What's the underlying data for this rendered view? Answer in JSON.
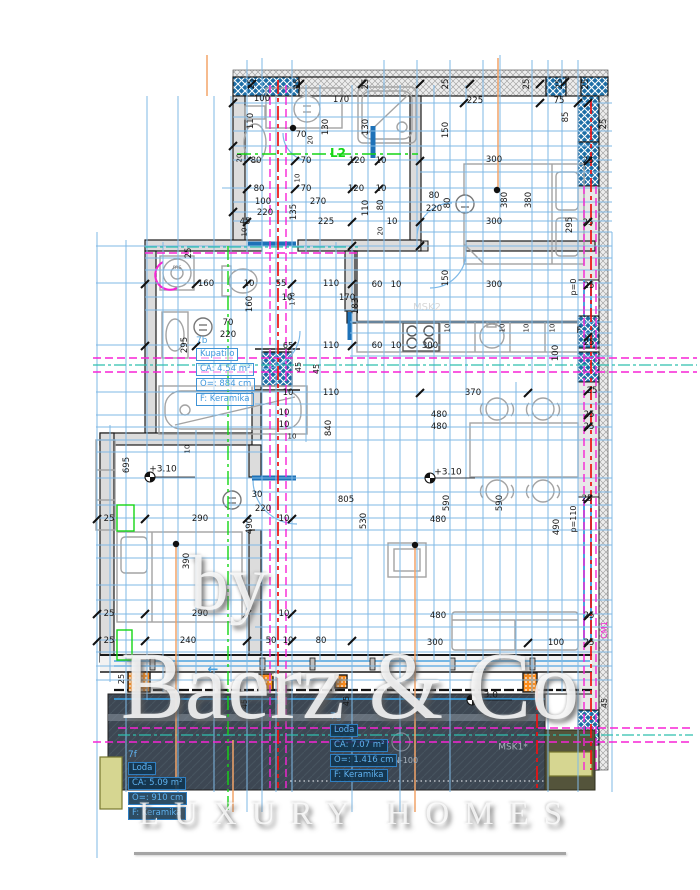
{
  "watermark": {
    "by": "by",
    "brand": "Baerz & Co",
    "tagline": "LUXURY HOMES"
  },
  "colors": {
    "grid_blue": "#7fb9e6",
    "hatch_blue": "#1d6ea6",
    "magenta": "#f723d5",
    "red": "#ee1111",
    "green": "#15d615",
    "teal": "#2fbfae",
    "orange_line": "#f2a469",
    "orange_column": "#ff8d1a",
    "terrace_dark": "#3d4753",
    "khaki": "#d6d691",
    "wall_gray": "#dcdcdc",
    "room_label_blue": "#43a0e8",
    "thick_blue": "#1e72b8"
  },
  "rooms": [
    {
      "id": "7b",
      "name": "Kupatilo",
      "area": "CA: 4.54 m²",
      "perimeter": "O=: 884 cm",
      "floor": "F: Keramika",
      "x": 196,
      "y": 336,
      "theme": "light"
    },
    {
      "id": "7f",
      "name": "Lođa",
      "area": "CA: 5.09 m²",
      "perimeter": "O=: 910 cm",
      "floor": "F: Keramika",
      "x": 128,
      "y": 750,
      "theme": "dark"
    },
    {
      "id": "7g",
      "name": "Lođa",
      "area": "CA: 7.07 m²",
      "perimeter": "O=: 1.416 cm",
      "floor": "F: Keramika",
      "x": 330,
      "y": 712,
      "theme": "dark"
    }
  ],
  "drawing": {
    "dims": [
      {
        "t": "25",
        "x": 252,
        "y": 84,
        "r": 1
      },
      {
        "t": "25",
        "x": 298,
        "y": 84,
        "r": 1
      },
      {
        "t": "25",
        "x": 366,
        "y": 84,
        "r": 1
      },
      {
        "t": "25",
        "x": 446,
        "y": 84,
        "r": 1
      },
      {
        "t": "25",
        "x": 527,
        "y": 84,
        "r": 1
      },
      {
        "t": "25",
        "x": 560,
        "y": 84,
        "r": 1
      },
      {
        "t": "25",
        "x": 586,
        "y": 84,
        "r": 1
      },
      {
        "t": "25",
        "x": 604,
        "y": 124,
        "r": 1
      },
      {
        "t": "100",
        "x": 262,
        "y": 99
      },
      {
        "t": "170",
        "x": 341,
        "y": 100
      },
      {
        "t": "110",
        "x": 251,
        "y": 121,
        "r": 1
      },
      {
        "t": "130",
        "x": 326,
        "y": 127,
        "r": 1
      },
      {
        "t": "130",
        "x": 366,
        "y": 127,
        "r": 1
      },
      {
        "t": "70",
        "x": 301,
        "y": 135
      },
      {
        "t": "20",
        "x": 311,
        "y": 140,
        "r": 1,
        "s": 7
      },
      {
        "t": "L2",
        "x": 338,
        "y": 153,
        "c": "green",
        "s": 12
      },
      {
        "t": "80",
        "x": 256,
        "y": 161
      },
      {
        "t": "70",
        "x": 306,
        "y": 161
      },
      {
        "t": "120",
        "x": 357,
        "y": 161
      },
      {
        "t": "10",
        "x": 381,
        "y": 161
      },
      {
        "t": "20",
        "x": 240,
        "y": 158,
        "r": 1,
        "s": 7
      },
      {
        "t": "80",
        "x": 259,
        "y": 189
      },
      {
        "t": "70",
        "x": 306,
        "y": 189
      },
      {
        "t": "120",
        "x": 356,
        "y": 189
      },
      {
        "t": "10",
        "x": 381,
        "y": 189
      },
      {
        "t": "10",
        "x": 298,
        "y": 178,
        "r": 1,
        "s": 7
      },
      {
        "t": "100",
        "x": 263,
        "y": 202
      },
      {
        "t": "270",
        "x": 318,
        "y": 202
      },
      {
        "t": "110",
        "x": 366,
        "y": 208,
        "r": 1
      },
      {
        "t": "80",
        "x": 381,
        "y": 205,
        "r": 1
      },
      {
        "t": "220",
        "x": 265,
        "y": 213
      },
      {
        "t": "135",
        "x": 294,
        "y": 212,
        "r": 1
      },
      {
        "t": "45",
        "x": 245,
        "y": 222
      },
      {
        "t": "225",
        "x": 326,
        "y": 222
      },
      {
        "t": "10",
        "x": 392,
        "y": 222
      },
      {
        "t": "20",
        "x": 381,
        "y": 231,
        "r": 1,
        "s": 7
      },
      {
        "t": "10",
        "x": 245,
        "y": 232,
        "r": 1,
        "s": 7
      },
      {
        "t": "225",
        "x": 475,
        "y": 101
      },
      {
        "t": "75",
        "x": 559,
        "y": 101
      },
      {
        "t": "85",
        "x": 566,
        "y": 117,
        "r": 1
      },
      {
        "t": "150",
        "x": 446,
        "y": 130,
        "r": 1
      },
      {
        "t": "300",
        "x": 494,
        "y": 160
      },
      {
        "t": "25",
        "x": 588,
        "y": 161
      },
      {
        "t": "80",
        "x": 434,
        "y": 196
      },
      {
        "t": "220",
        "x": 434,
        "y": 209
      },
      {
        "t": "80",
        "x": 448,
        "y": 203,
        "r": 1
      },
      {
        "t": "380",
        "x": 505,
        "y": 200,
        "r": 1
      },
      {
        "t": "380",
        "x": 529,
        "y": 200,
        "r": 1
      },
      {
        "t": "300",
        "x": 494,
        "y": 222
      },
      {
        "t": "295",
        "x": 570,
        "y": 225,
        "r": 1
      },
      {
        "t": "25",
        "x": 588,
        "y": 223
      },
      {
        "t": "150",
        "x": 446,
        "y": 278,
        "r": 1
      },
      {
        "t": "300",
        "x": 494,
        "y": 285
      },
      {
        "t": "p=0",
        "x": 574,
        "y": 287,
        "r": 1,
        "s": 8
      },
      {
        "t": "25",
        "x": 589,
        "y": 286
      },
      {
        "t": "25",
        "x": 189,
        "y": 253,
        "r": 1
      },
      {
        "t": "160",
        "x": 206,
        "y": 284
      },
      {
        "t": "10",
        "x": 249,
        "y": 284
      },
      {
        "t": "55",
        "x": 281,
        "y": 284
      },
      {
        "t": "110",
        "x": 331,
        "y": 284
      },
      {
        "t": "10",
        "x": 287,
        "y": 298
      },
      {
        "t": "170",
        "x": 347,
        "y": 298
      },
      {
        "t": "160",
        "x": 250,
        "y": 304,
        "r": 1
      },
      {
        "t": "170",
        "x": 293,
        "y": 299,
        "r": 1,
        "s": 7
      },
      {
        "t": "70",
        "x": 228,
        "y": 323
      },
      {
        "t": "220",
        "x": 228,
        "y": 335
      },
      {
        "t": "295",
        "x": 185,
        "y": 345,
        "r": 1
      },
      {
        "t": "65",
        "x": 288,
        "y": 346,
        "s": 8
      },
      {
        "t": "110",
        "x": 331,
        "y": 346
      },
      {
        "t": "45",
        "x": 299,
        "y": 367,
        "r": 1,
        "s": 8
      },
      {
        "t": "45",
        "x": 317,
        "y": 369,
        "r": 1,
        "s": 8
      },
      {
        "t": "110",
        "x": 331,
        "y": 393
      },
      {
        "t": "10",
        "x": 288,
        "y": 393
      },
      {
        "t": "10",
        "x": 284,
        "y": 413
      },
      {
        "t": "10",
        "x": 284,
        "y": 425
      },
      {
        "t": "840",
        "x": 329,
        "y": 428,
        "r": 1
      },
      {
        "t": "10",
        "x": 292,
        "y": 437,
        "s": 7
      },
      {
        "t": "60",
        "x": 377,
        "y": 285
      },
      {
        "t": "10",
        "x": 396,
        "y": 285
      },
      {
        "t": "183",
        "x": 356,
        "y": 306,
        "r": 1
      },
      {
        "t": "MSK2",
        "x": 427,
        "y": 308,
        "c": "faint",
        "s": 10
      },
      {
        "t": "10",
        "x": 448,
        "y": 328,
        "r": 1,
        "s": 7
      },
      {
        "t": "10",
        "x": 503,
        "y": 328,
        "r": 1,
        "s": 7
      },
      {
        "t": "10",
        "x": 527,
        "y": 328,
        "r": 1,
        "s": 7
      },
      {
        "t": "10",
        "x": 553,
        "y": 328,
        "r": 1,
        "s": 7
      },
      {
        "t": "F",
        "x": 579,
        "y": 331
      },
      {
        "t": "300",
        "x": 430,
        "y": 346
      },
      {
        "t": "60",
        "x": 377,
        "y": 346
      },
      {
        "t": "10",
        "x": 396,
        "y": 346
      },
      {
        "t": "100",
        "x": 556,
        "y": 353,
        "r": 1
      },
      {
        "t": "370",
        "x": 473,
        "y": 393
      },
      {
        "t": "25",
        "x": 592,
        "y": 391
      },
      {
        "t": "480",
        "x": 439,
        "y": 415
      },
      {
        "t": "480",
        "x": 439,
        "y": 427
      },
      {
        "t": "25",
        "x": 589,
        "y": 415
      },
      {
        "t": "25",
        "x": 589,
        "y": 427
      },
      {
        "t": "25",
        "x": 589,
        "y": 343
      },
      {
        "t": "+3.10",
        "x": 448,
        "y": 473,
        "s": 9
      },
      {
        "t": "590",
        "x": 447,
        "y": 503,
        "r": 1
      },
      {
        "t": "590",
        "x": 500,
        "y": 503,
        "r": 1
      },
      {
        "t": "805",
        "x": 346,
        "y": 500
      },
      {
        "t": "530",
        "x": 364,
        "y": 521,
        "r": 1
      },
      {
        "t": "480",
        "x": 438,
        "y": 520
      },
      {
        "t": "490",
        "x": 557,
        "y": 527,
        "r": 1
      },
      {
        "t": "p=110",
        "x": 574,
        "y": 519,
        "r": 1,
        "s": 8
      },
      {
        "t": "25",
        "x": 587,
        "y": 499
      },
      {
        "t": "480",
        "x": 438,
        "y": 616
      },
      {
        "t": "300",
        "x": 435,
        "y": 643
      },
      {
        "t": "100",
        "x": 556,
        "y": 643
      },
      {
        "t": "25",
        "x": 589,
        "y": 616
      },
      {
        "t": "25",
        "x": 589,
        "y": 643
      },
      {
        "t": "10",
        "x": 188,
        "y": 449,
        "r": 1,
        "s": 7
      },
      {
        "t": "695",
        "x": 127,
        "y": 465,
        "r": 1
      },
      {
        "t": "+3.10",
        "x": 163,
        "y": 470,
        "s": 9
      },
      {
        "t": "30",
        "x": 257,
        "y": 495
      },
      {
        "t": "220",
        "x": 263,
        "y": 509
      },
      {
        "t": "10",
        "x": 284,
        "y": 519
      },
      {
        "t": "290",
        "x": 200,
        "y": 519
      },
      {
        "t": "490",
        "x": 250,
        "y": 526,
        "r": 1
      },
      {
        "t": "25",
        "x": 109,
        "y": 519
      },
      {
        "t": "390",
        "x": 187,
        "y": 561,
        "r": 1
      },
      {
        "t": "290",
        "x": 200,
        "y": 614
      },
      {
        "t": "25",
        "x": 109,
        "y": 614
      },
      {
        "t": "10",
        "x": 284,
        "y": 614
      },
      {
        "t": "240",
        "x": 188,
        "y": 641
      },
      {
        "t": "50",
        "x": 271,
        "y": 641
      },
      {
        "t": "10",
        "x": 288,
        "y": 641
      },
      {
        "t": "80",
        "x": 321,
        "y": 641
      },
      {
        "t": "25",
        "x": 109,
        "y": 641
      },
      {
        "t": "25",
        "x": 122,
        "y": 679,
        "r": 1,
        "s": 8
      },
      {
        "t": "45",
        "x": 245,
        "y": 704,
        "r": 1,
        "s": 8
      },
      {
        "t": "45",
        "x": 283,
        "y": 701,
        "r": 1,
        "s": 8
      },
      {
        "t": "45",
        "x": 347,
        "y": 701,
        "r": 1,
        "s": 8
      },
      {
        "t": "45",
        "x": 605,
        "y": 703,
        "r": 1,
        "s": 8
      },
      {
        "t": "+3.0",
        "x": 487,
        "y": 696,
        "s": 9
      },
      {
        "t": "MSK1*",
        "x": 513,
        "y": 748,
        "c": "dark-note",
        "s": 9
      },
      {
        "t": "ps DN-100",
        "x": 397,
        "y": 761,
        "c": "dark-note",
        "s": 8
      },
      {
        "t": "CM1",
        "x": 605,
        "y": 630,
        "r": 1,
        "c": "magenta",
        "s": 8
      },
      {
        "t": "←",
        "x": 213,
        "y": 670,
        "c": "bluearrow",
        "s": 13
      },
      {
        "t": "←",
        "x": 481,
        "y": 670,
        "c": "bluearrow",
        "s": 13
      },
      {
        "t": "ms",
        "x": 177,
        "y": 268,
        "c": "gray",
        "s": 6
      }
    ],
    "vlines": [
      [
        97,
        232,
        858
      ],
      [
        110,
        425,
        682
      ],
      [
        126,
        240,
        792
      ],
      [
        147,
        96,
        700
      ],
      [
        163,
        242,
        692
      ],
      [
        178,
        96,
        792
      ],
      [
        196,
        430,
        682
      ],
      [
        214,
        96,
        792
      ],
      [
        231,
        96,
        682
      ],
      [
        247,
        60,
        812
      ],
      [
        262,
        58,
        812
      ],
      [
        276,
        96,
        792
      ],
      [
        292,
        60,
        792
      ],
      [
        306,
        85,
        442
      ],
      [
        320,
        85,
        662
      ],
      [
        336,
        242,
        662
      ],
      [
        352,
        85,
        812
      ],
      [
        368,
        85,
        662
      ],
      [
        384,
        60,
        662
      ],
      [
        400,
        85,
        812
      ],
      [
        417,
        60,
        662
      ],
      [
        434,
        85,
        662
      ],
      [
        450,
        60,
        792
      ],
      [
        466,
        85,
        662
      ],
      [
        483,
        60,
        662
      ],
      [
        500,
        55,
        662
      ],
      [
        516,
        382,
        662
      ],
      [
        532,
        60,
        692
      ],
      [
        548,
        60,
        792
      ],
      [
        562,
        60,
        692
      ],
      [
        578,
        60,
        792
      ],
      [
        612,
        232,
        792
      ]
    ],
    "hlines": [
      [
        103,
        233,
        612
      ],
      [
        117,
        233,
        420
      ],
      [
        131,
        233,
        612
      ],
      [
        146,
        233,
        612
      ],
      [
        160,
        233,
        612
      ],
      [
        172,
        420,
        612
      ],
      [
        188,
        222,
        612
      ],
      [
        202,
        233,
        612
      ],
      [
        212,
        233,
        612
      ],
      [
        221,
        233,
        612
      ],
      [
        232,
        420,
        612
      ],
      [
        246,
        96,
        612
      ],
      [
        258,
        145,
        612
      ],
      [
        270,
        145,
        612
      ],
      [
        283,
        96,
        612
      ],
      [
        297,
        145,
        612
      ],
      [
        310,
        145,
        612
      ],
      [
        322,
        350,
        612
      ],
      [
        333,
        350,
        612
      ],
      [
        345,
        96,
        612
      ],
      [
        356,
        350,
        612
      ],
      [
        392,
        96,
        612
      ],
      [
        404,
        255,
        612
      ],
      [
        415,
        96,
        612
      ],
      [
        427,
        96,
        612
      ],
      [
        440,
        96,
        612
      ],
      [
        452,
        96,
        352
      ],
      [
        478,
        96,
        612
      ],
      [
        492,
        255,
        612
      ],
      [
        505,
        96,
        612
      ],
      [
        518,
        96,
        612
      ],
      [
        530,
        255,
        612
      ],
      [
        545,
        96,
        612
      ],
      [
        558,
        96,
        352
      ],
      [
        585,
        96,
        352
      ],
      [
        600,
        96,
        612
      ],
      [
        614,
        96,
        612
      ],
      [
        627,
        255,
        612
      ],
      [
        640,
        96,
        612
      ],
      [
        652,
        96,
        612
      ],
      [
        666,
        96,
        612
      ],
      [
        680,
        96,
        612
      ]
    ],
    "ticks": [
      [
        247,
        161
      ],
      [
        295,
        161
      ],
      [
        352,
        161
      ],
      [
        379,
        161
      ],
      [
        420,
        161
      ],
      [
        588,
        161
      ],
      [
        247,
        189
      ],
      [
        295,
        189
      ],
      [
        352,
        189
      ],
      [
        379,
        189
      ],
      [
        420,
        222
      ],
      [
        247,
        222
      ],
      [
        352,
        222
      ],
      [
        588,
        222
      ],
      [
        464,
        103
      ],
      [
        540,
        103
      ],
      [
        578,
        103
      ],
      [
        588,
        285
      ],
      [
        565,
        82
      ],
      [
        540,
        84
      ],
      [
        470,
        84
      ],
      [
        420,
        84
      ],
      [
        362,
        84
      ],
      [
        300,
        84
      ],
      [
        252,
        84
      ],
      [
        588,
        391
      ],
      [
        588,
        415
      ],
      [
        588,
        427
      ],
      [
        588,
        499
      ],
      [
        145,
        284
      ],
      [
        196,
        284
      ],
      [
        247,
        284
      ],
      [
        292,
        284
      ],
      [
        352,
        284
      ],
      [
        145,
        346
      ],
      [
        196,
        346
      ],
      [
        292,
        346
      ],
      [
        352,
        346
      ],
      [
        97,
        519
      ],
      [
        145,
        519
      ],
      [
        247,
        519
      ],
      [
        292,
        519
      ],
      [
        97,
        614
      ],
      [
        145,
        614
      ],
      [
        247,
        614
      ],
      [
        292,
        614
      ],
      [
        97,
        641
      ],
      [
        145,
        641
      ],
      [
        247,
        641
      ],
      [
        292,
        641
      ],
      [
        352,
        641
      ],
      [
        588,
        616
      ],
      [
        588,
        643
      ],
      [
        528,
        643
      ],
      [
        352,
        246
      ],
      [
        420,
        246
      ],
      [
        588,
        337
      ],
      [
        233,
        103
      ],
      [
        233,
        146
      ],
      [
        233,
        212
      ],
      [
        420,
        393
      ],
      [
        528,
        393
      ],
      [
        588,
        103
      ]
    ]
  }
}
